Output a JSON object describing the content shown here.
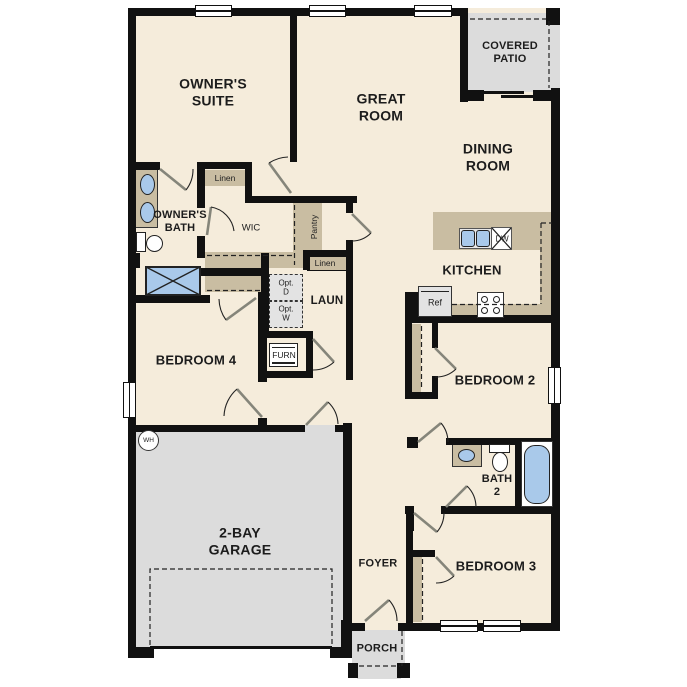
{
  "plan_title": "single-story residential floor plan",
  "colors": {
    "wall": "#111111",
    "floor": "#f5ecdb",
    "cabinet": "#c9bda2",
    "garage": "#dcdcdc",
    "fixture": "#a9c9ea",
    "appliance": "#e3e3e3"
  },
  "rooms": {
    "owners_suite": "OWNER'S\nSUITE",
    "great_room": "GREAT\nROOM",
    "covered_patio": "COVERED\nPATIO",
    "dining_room": "DINING\nROOM",
    "kitchen": "KITCHEN",
    "owners_bath": "OWNER'S\nBATH",
    "wic": "WIC",
    "laundry": "LAUN",
    "bedroom_4": "BEDROOM 4",
    "bedroom_2": "BEDROOM 2",
    "bedroom_3": "BEDROOM 3",
    "bath_2": "BATH\n2",
    "garage": "2-BAY\nGARAGE",
    "foyer": "FOYER",
    "porch": "PORCH"
  },
  "features": {
    "linen_wic": "Linen",
    "linen_hall": "Linen",
    "pantry": "Pantry",
    "opt_dryer": "Opt.\nD",
    "opt_washer": "Opt.\nW",
    "furnace": "FURN",
    "water_heater": "WH",
    "refrigerator": "Ref",
    "dishwasher": "DW"
  }
}
